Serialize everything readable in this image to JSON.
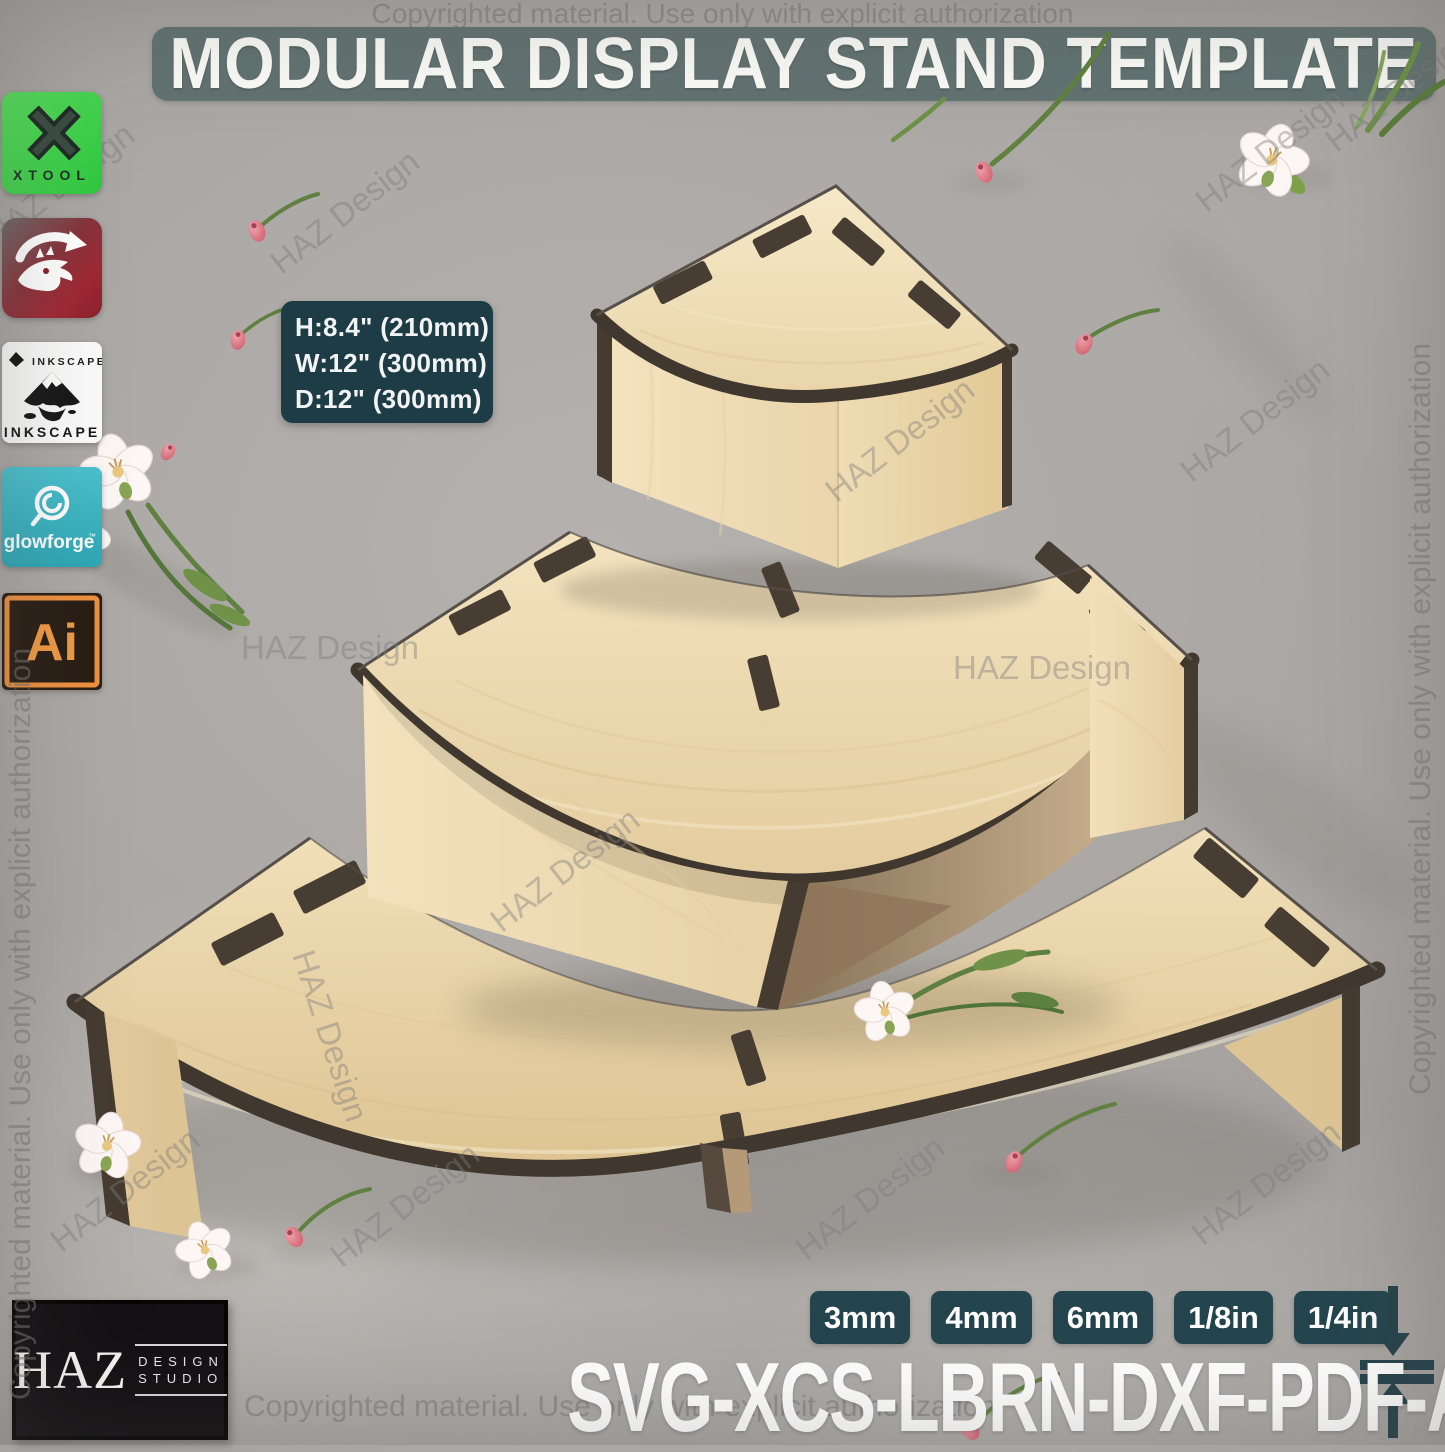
{
  "header": {
    "title": "MODULAR DISPLAY STAND TEMPLATE"
  },
  "watermarks": {
    "copyright": "Copyrighted material. Use only with explicit authorization",
    "brand": "HAZ Design"
  },
  "software_icons": [
    {
      "id": "xtool",
      "label": "XTOOL"
    },
    {
      "id": "lightburn",
      "label": ""
    },
    {
      "id": "inkscape",
      "label": "INKSCAPE"
    },
    {
      "id": "glowforge",
      "label": "glowforge",
      "tm": "™"
    },
    {
      "id": "illustrator",
      "label": "Ai"
    }
  ],
  "dimensions": {
    "height": "H:8.4\" (210mm)",
    "width": "W:12\" (300mm)",
    "depth": "D:12\" (300mm)"
  },
  "material_thickness": [
    "3mm",
    "4mm",
    "6mm",
    "1/8in",
    "1/4in"
  ],
  "file_formats": "SVG-XCS-LBRN-DXF-PDF-AI-CDR",
  "logo": {
    "name": "HAZ",
    "line1": "DESIGN",
    "line2": "STUDIO"
  },
  "colors": {
    "accent_teal": "#24454e",
    "banner_teal": "#5f7170",
    "wood_light": "#eedcb3",
    "wood_edge": "#453b31",
    "background_concrete": "#aca9a6",
    "xtool_green": "#3ed44d",
    "lightburn_red": "#a3232e",
    "glowforge_teal": "#3eb5c4",
    "illustrator_orange": "#f09b43"
  }
}
